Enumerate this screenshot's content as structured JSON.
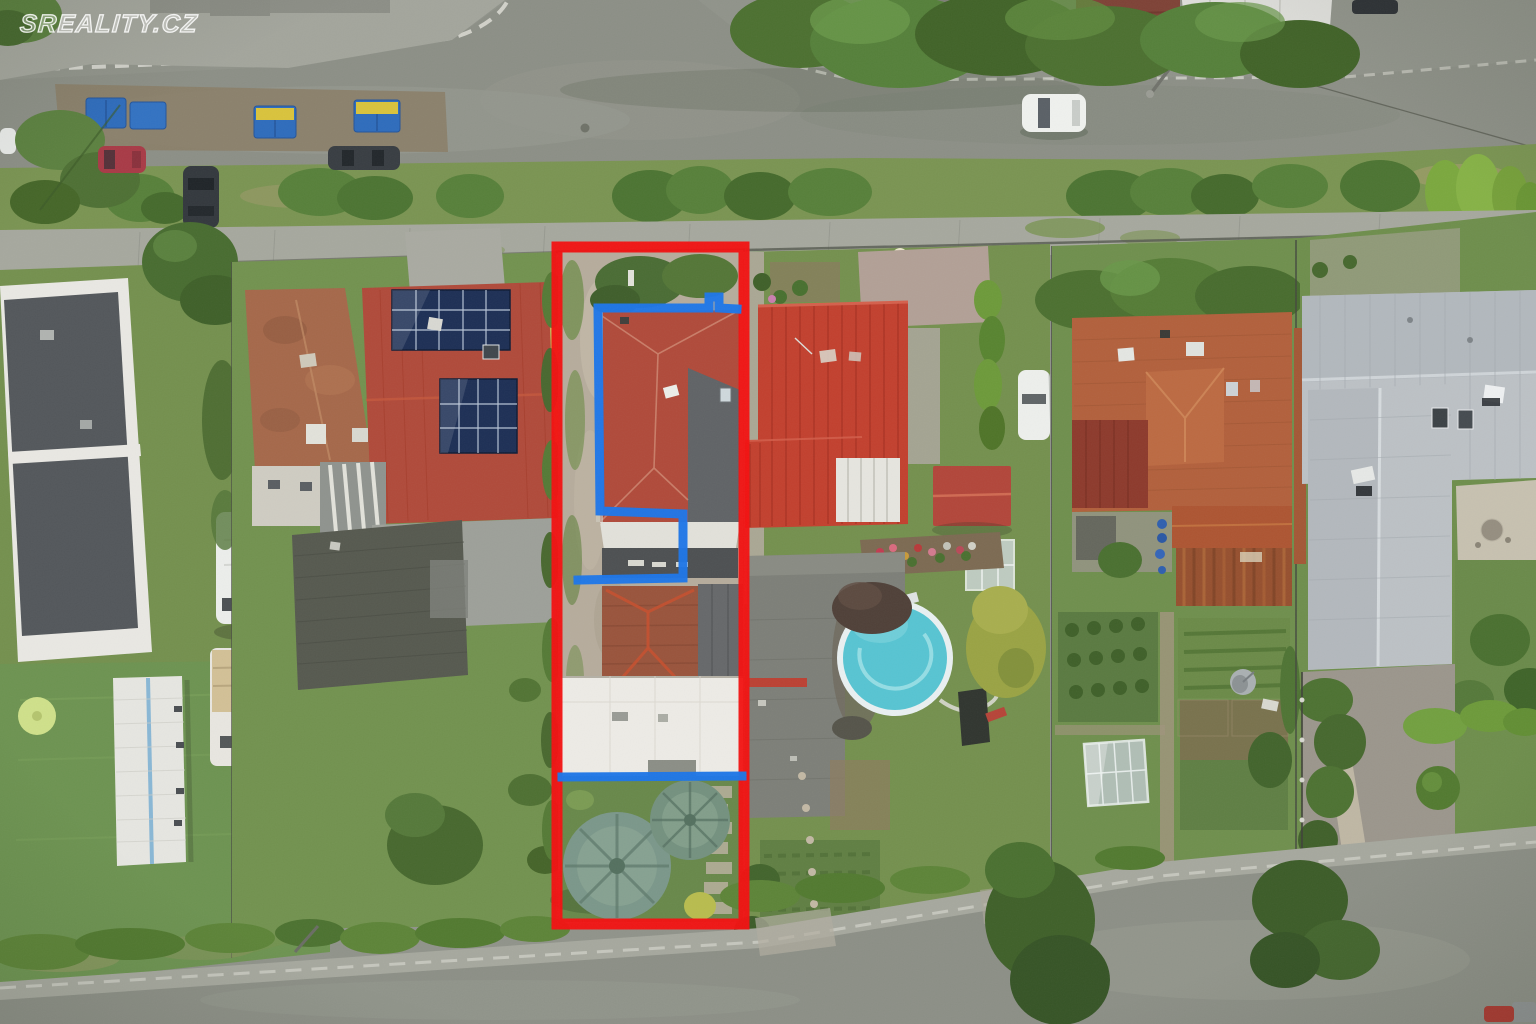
{
  "watermark": {
    "text": "SREALITY.CZ"
  },
  "annotations": {
    "property_boundary": {
      "label": "property boundary outline",
      "shape": "rectangle",
      "color_key": "annotation-red"
    },
    "house_footprint": {
      "label": "building footprint outline",
      "shape": "polyline",
      "color_key": "annotation-blue"
    }
  },
  "palette": {
    "annotation-red": "#f31111",
    "annotation-blue": "#1d76e8",
    "watermark": "rgba(255,255,255,0.85)",
    "asphalt": "#8c8f86",
    "sidewalk": "#a6a89e",
    "grass": "#74904e",
    "pool-water": "#57c4d2",
    "pool-rim": "#e9f0f1",
    "roof-red-bright": "#c2402e",
    "roof-red-subject": "#b04a3a",
    "roof-orange": "#b2603c",
    "roof-silver": "#bcc1c5",
    "solar-panel": "#1d2f55",
    "white-building": "#edebe6"
  }
}
